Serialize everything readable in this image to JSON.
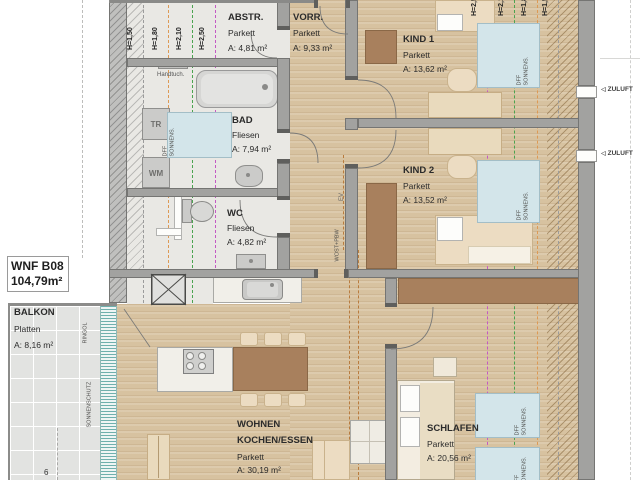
{
  "title_box": {
    "code": "WNF B08",
    "area": "104,79m²"
  },
  "rooms": {
    "abstr": {
      "name": "ABSTR.",
      "floor": "Parkett",
      "area": "A: 4,81 m²"
    },
    "vorr": {
      "name": "VORR.",
      "floor": "Parkett",
      "area": "A: 9,33 m²"
    },
    "kind1": {
      "name": "KIND 1",
      "floor": "Parkett",
      "area": "A: 13,62 m²"
    },
    "bad": {
      "name": "BAD",
      "floor": "Fliesen",
      "area": "A: 7,94 m²"
    },
    "kind2": {
      "name": "KIND 2",
      "floor": "Parkett",
      "area": "A: 13,52 m²"
    },
    "wc": {
      "name": "WC",
      "floor": "Fliesen",
      "area": "A: 4,82 m²"
    },
    "wohnen": {
      "name_line1": "WOHNEN",
      "name_line2": "KOCHEN/ESSEN",
      "floor": "Parkett",
      "area": "A: 30,19 m²"
    },
    "schlafen": {
      "name": "SCHLAFEN",
      "floor": "Parkett",
      "area": "A: 20,56 m²"
    },
    "balkon": {
      "name": "BALKON",
      "floor": "Platten",
      "area": "A: 8,16 m²"
    }
  },
  "height_lines": {
    "left": [
      "H=1,50",
      "H=1,80",
      "H=2,10",
      "H=2,50"
    ],
    "right": [
      "H=2,50",
      "H=2,10",
      "H=1,80",
      "H=1,50"
    ]
  },
  "appliances": {
    "tr": "TR",
    "wm": "WM",
    "handtuch": "Handtuch."
  },
  "annotations": {
    "ev": "EV",
    "wost": "WOST+PBW",
    "ringol": "RINGOL",
    "sonnenschutz": "SONNENSCHUTZ",
    "zuluft": "ZULUFT",
    "zuluft_arrow": "◁",
    "axis": "6",
    "rooflight_line1": "DFF",
    "rooflight_line2": "SONNENS."
  },
  "colors": {
    "wood": "#d7c2a0",
    "tile": "#e9e8e4",
    "wall": "#a2a2a0",
    "wall_dark": "#6f6f6d",
    "rooflight_blue": "#d3e5ea",
    "furniture_brown": "#a8805d",
    "furniture_beige": "#ecdcc2",
    "balcony_tile": "#e2e3e1",
    "sunshade_teal": "#6fb0ad",
    "line_grey": "#9b9b9b",
    "line_orange": "#dd9a55",
    "line_green": "#4aa34f",
    "line_magenta": "#c45ac4",
    "beam_brown": "#b97c3e"
  }
}
